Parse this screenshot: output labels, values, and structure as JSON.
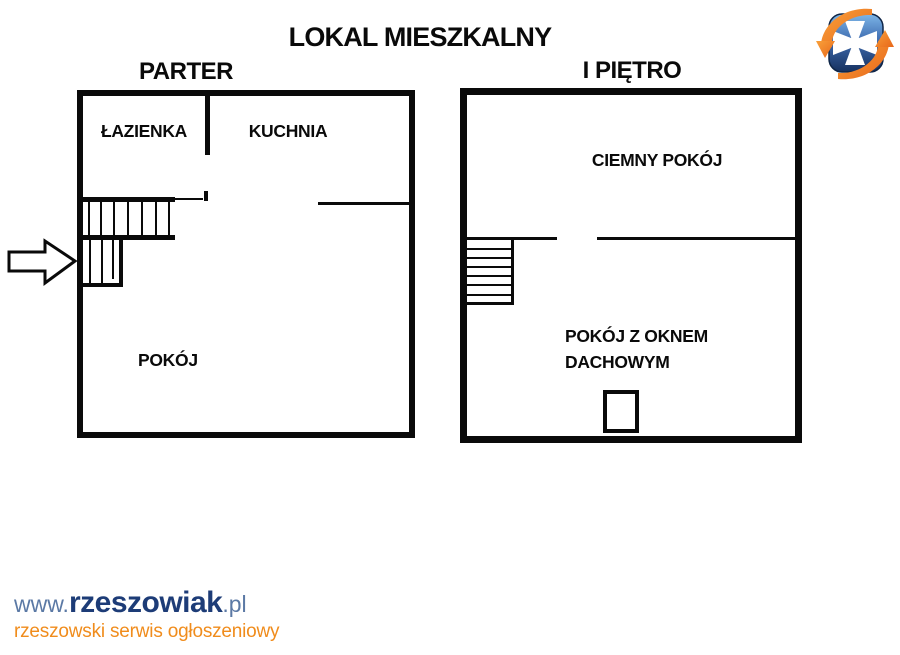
{
  "title": "LOKAL MIESZKALNY",
  "parter": {
    "label": "PARTER",
    "room_lazienka": "ŁAZIENKA",
    "room_kuchnia": "KUCHNIA",
    "room_pokoj": "POKÓJ"
  },
  "pietro": {
    "label": "I PIĘTRO",
    "room_ciemny": "CIEMNY POKÓJ",
    "room_dachowy_line1": "POKÓJ Z OKNEM",
    "room_dachowy_line2": "DACHOWYM"
  },
  "footer": {
    "www": "www.",
    "brand": "rzeszowiak",
    "tld": ".pl",
    "tagline": "rzeszowski serwis ogłoszeniowy"
  },
  "colors": {
    "plan_line": "#0a0a0a",
    "brand_navy": "#1d3c77",
    "url_slate": "#5b79a5",
    "tagline_orange": "#f08c1c",
    "logo_orange_light": "#f9a13a",
    "logo_orange_dark": "#e8671a",
    "logo_blue_light": "#7db6e8",
    "logo_blue_dark": "#16315f"
  }
}
